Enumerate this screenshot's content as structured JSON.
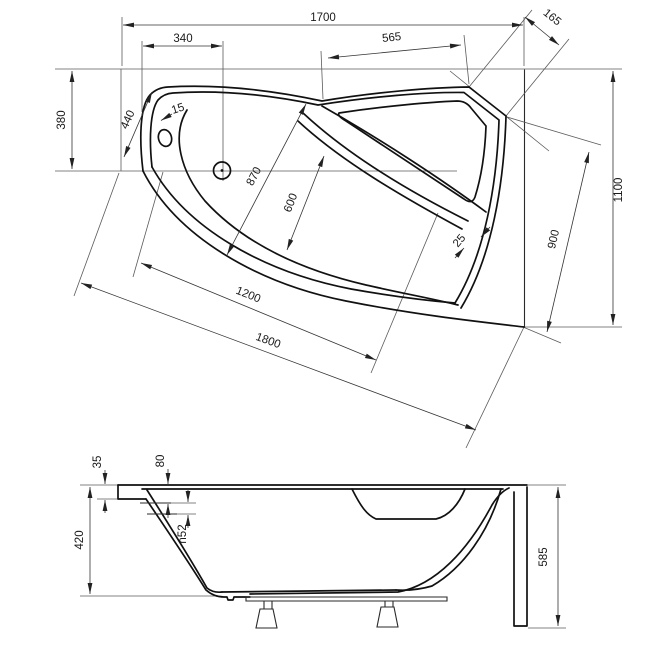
{
  "drawing": {
    "line_color": "#111111",
    "background": "#ffffff",
    "top_view": {
      "overall_length": "1700",
      "corner_cut": "165",
      "drain_offset": "340",
      "back_edge_right": "565",
      "left_end_depth": "380",
      "left_edge": "440",
      "rim_left": "15",
      "diagonal_870": "870",
      "basin_width": "600",
      "rim_right": "25",
      "inner_diagonal": "1200",
      "outer_diagonal": "1800",
      "overall_width": "1100",
      "right_span": "900"
    },
    "side_view": {
      "rim_height": "35",
      "rim_drop": "80",
      "overflow_diameter": "n52",
      "shell_depth": "420",
      "total_height": "585"
    }
  }
}
